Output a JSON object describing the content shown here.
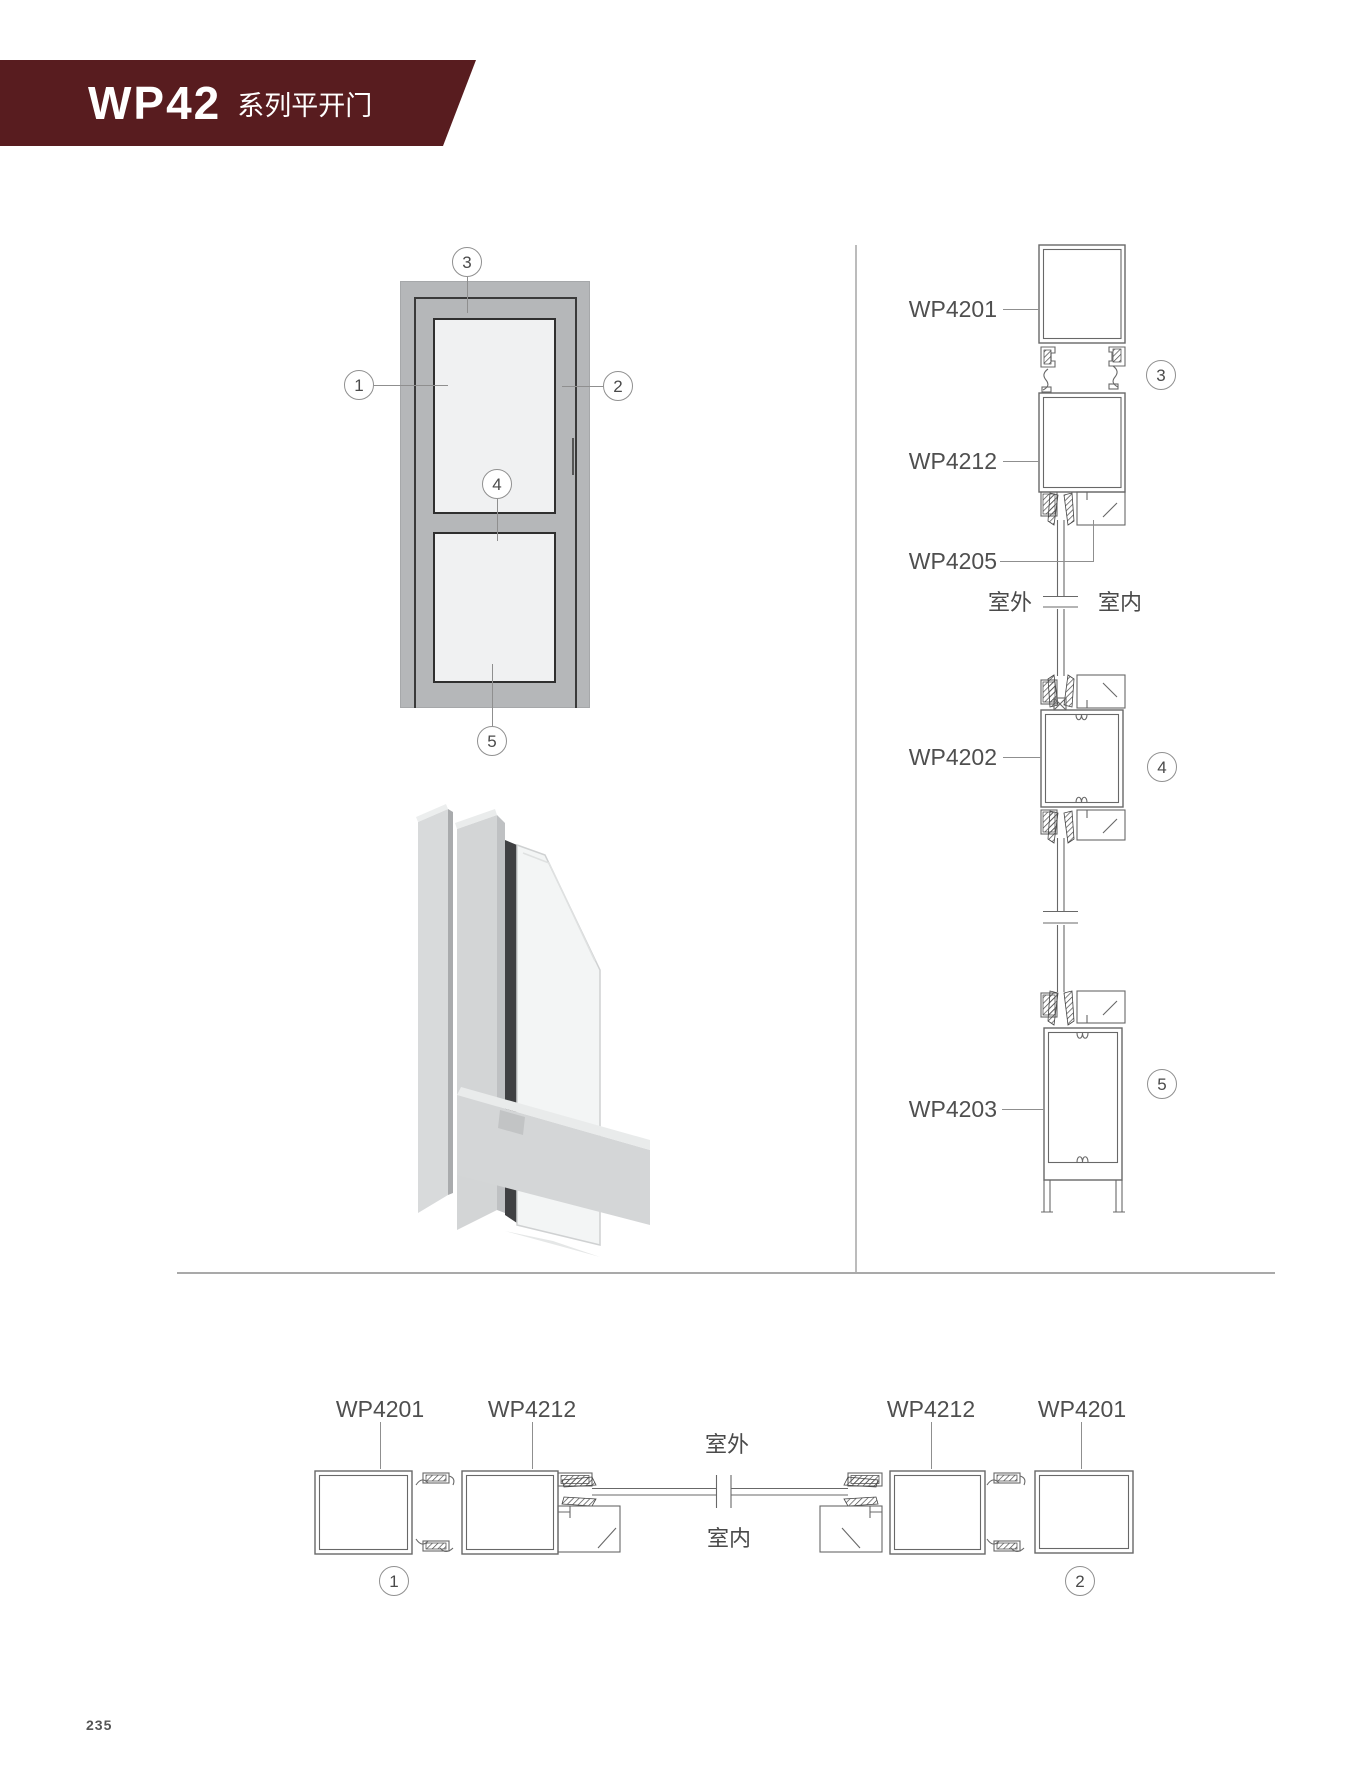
{
  "header": {
    "series": "WP42",
    "name": "系列平开门",
    "banner_color": "#581c1f"
  },
  "page_number": "235",
  "colors": {
    "banner": "#581c1f",
    "door_frame_gray": "#b5b7b9",
    "glass_panel": "#f0f1f2",
    "drawing_line": "#686868",
    "label_text": "#4f4f4f"
  },
  "front_view": {
    "callouts": [
      "1",
      "2",
      "3",
      "4",
      "5"
    ]
  },
  "vertical_section": {
    "profile_labels": [
      "WP4201",
      "WP4212",
      "WP4205",
      "WP4202",
      "WP4203"
    ],
    "outside_label": "室外",
    "inside_label": "室内",
    "callouts": [
      "3",
      "4",
      "5"
    ]
  },
  "horizontal_section": {
    "profile_labels": [
      "WP4201",
      "WP4212",
      "WP4212",
      "WP4201"
    ],
    "outside_label": "室外",
    "inside_label": "室内",
    "callouts": [
      "1",
      "2"
    ]
  }
}
